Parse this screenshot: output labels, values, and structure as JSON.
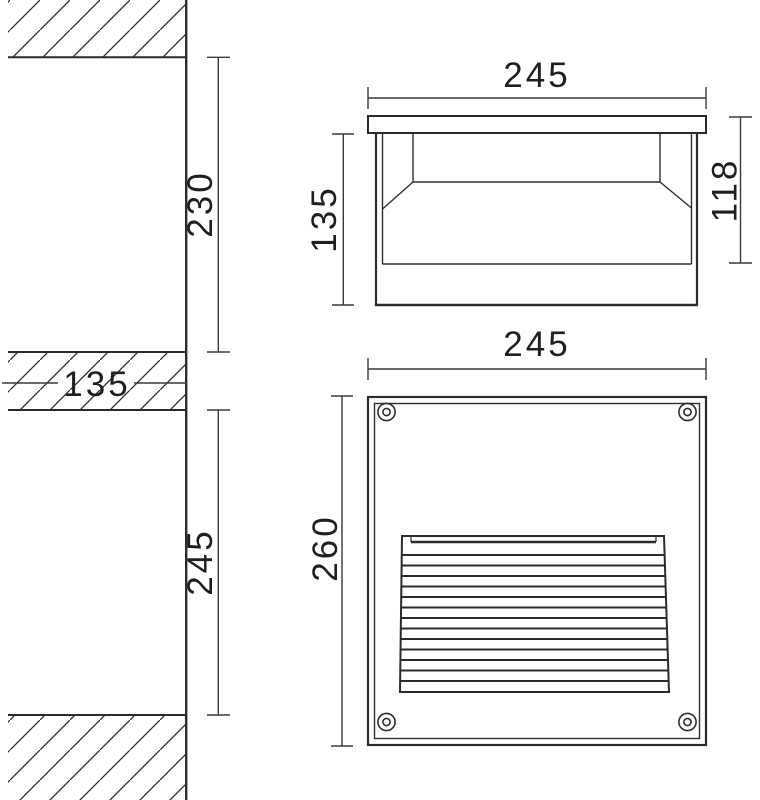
{
  "page": {
    "background": "#ffffff",
    "line_color": "#2b2b2b",
    "dimension_line_color": "#3a3a3a",
    "text_color": "#1f1f1f"
  },
  "wall_section_view": {
    "description": "wall installation section with hatched wall cuts",
    "dimensions": {
      "offset_above": "230",
      "wall_thickness": "135",
      "opening_height": "245"
    }
  },
  "side_view": {
    "description": "fixture side section with flange and reflector",
    "dimensions": {
      "width": "245",
      "body_depth": "135",
      "recess_depth": "118"
    }
  },
  "front_view": {
    "description": "fixture front face with louver grille and corner screws",
    "dimensions": {
      "width": "245",
      "height": "260"
    }
  }
}
